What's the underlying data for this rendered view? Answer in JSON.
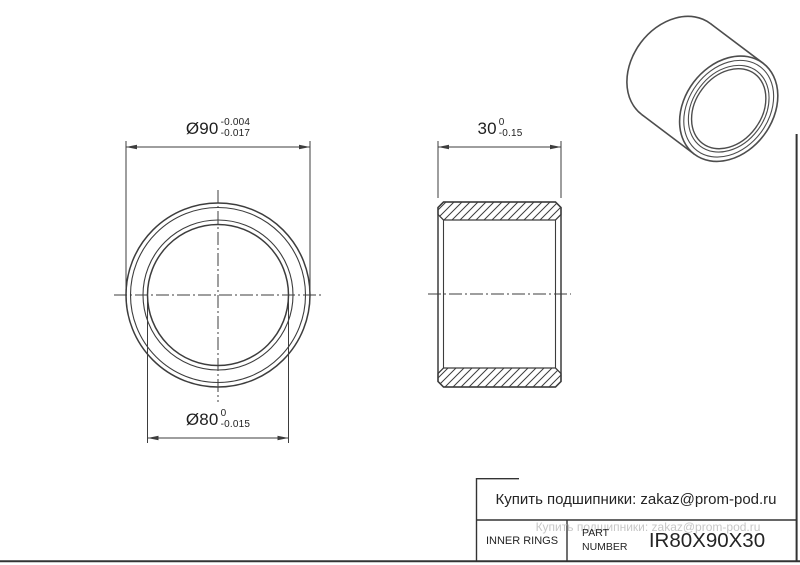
{
  "page": {
    "background": "#ffffff",
    "line_color": "#3d3d3d",
    "iso_line_color": "#4d4d4d",
    "text_color": "#1f1f1f",
    "watermark_color": "#c7c7c7"
  },
  "dimensions": {
    "outer_diameter": {
      "text": "Ø90",
      "upper": "-0.004",
      "lower": "-0.017"
    },
    "bore_diameter": {
      "text": "Ø80",
      "upper": "0",
      "lower": "-0.015"
    },
    "width": {
      "text": "30",
      "upper": "0",
      "lower": "-0.15"
    }
  },
  "title_block": {
    "contact": "Купить подшипники: zakaz@prom-pod.ru",
    "watermark": "Купить подшипники: zakaz@prom-pod.ru",
    "category": "INNER RINGS",
    "part_label_line1": "PART",
    "part_label_line2": "NUMBER",
    "part_number": "IR80X90X30"
  }
}
